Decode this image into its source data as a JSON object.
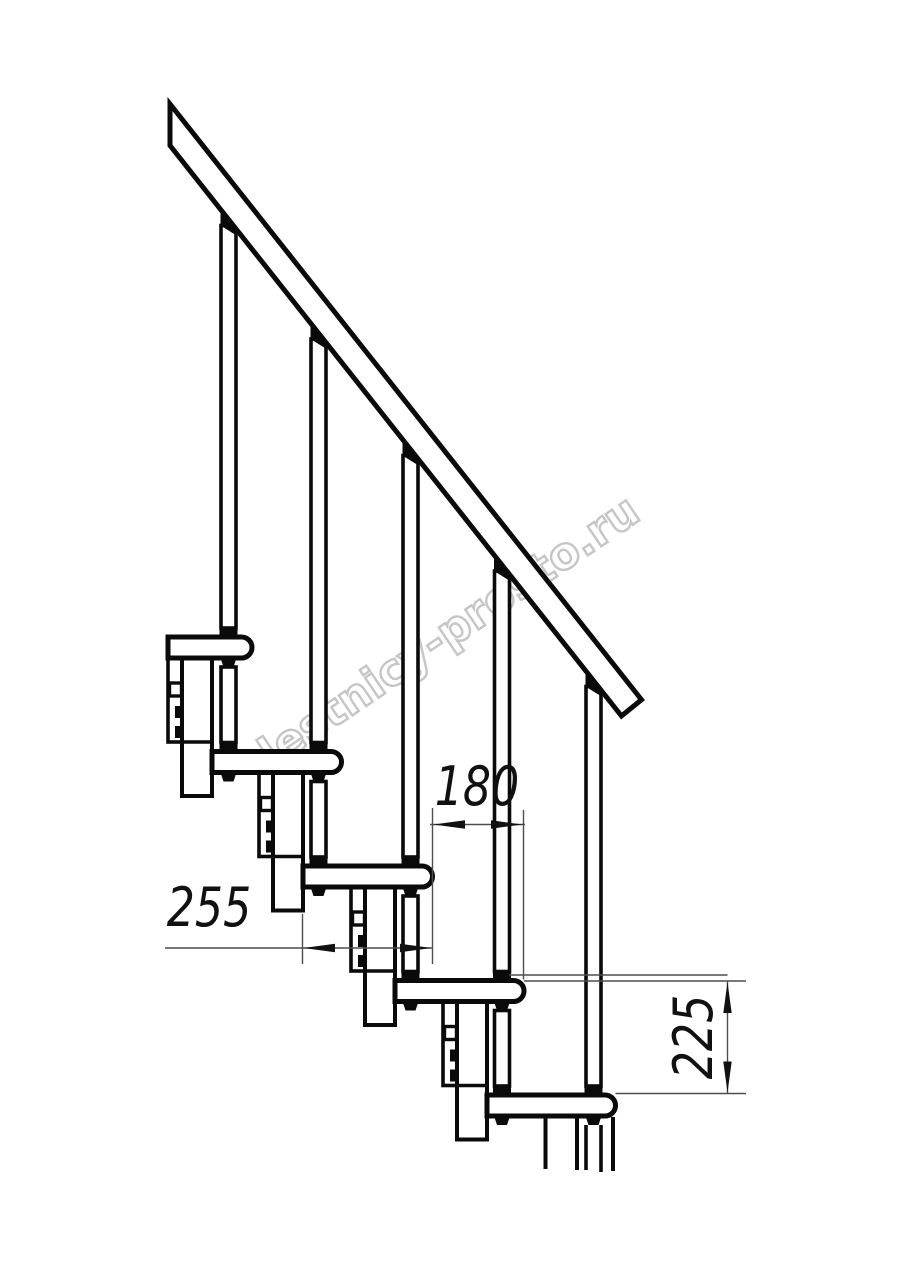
{
  "watermark": {
    "text": "lestnicy-prosto.ru",
    "color": "#c6c6c6"
  },
  "dimensions": {
    "tread_depth": {
      "value": "255"
    },
    "step_run": {
      "value": "180"
    },
    "riser_height": {
      "value": "225"
    }
  },
  "colors": {
    "line": "#0a0a0a",
    "dim_line": "#4d4d4d",
    "background": "#ffffff"
  }
}
